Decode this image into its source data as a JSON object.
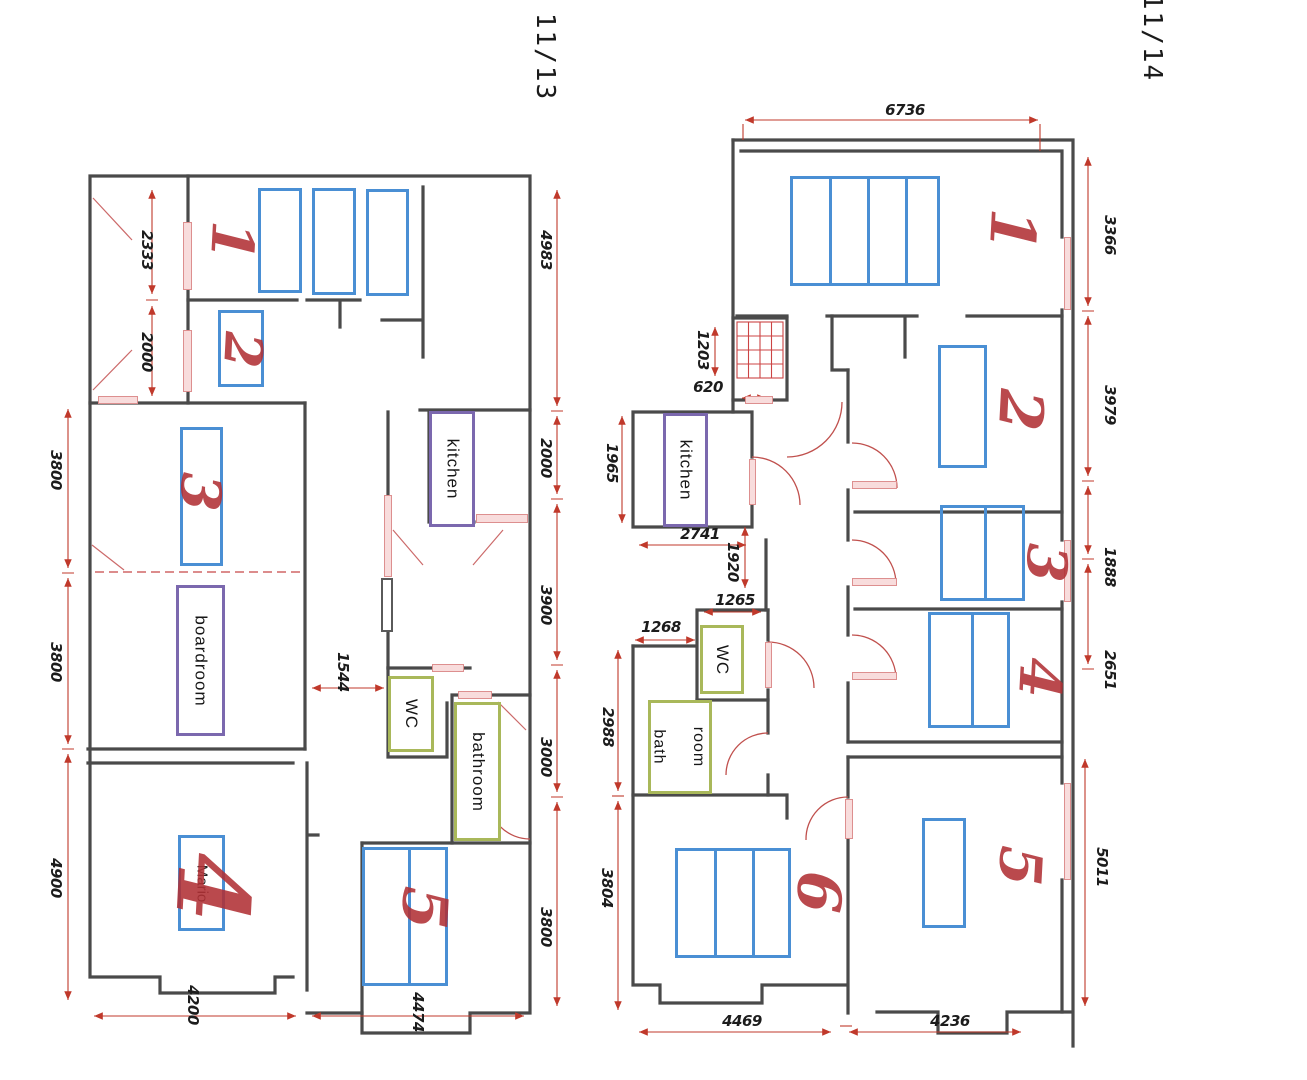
{
  "sheet": {
    "kind": "scanned architectural floor plans, two pages side by side"
  },
  "page_left": {
    "page_number": "11/13",
    "rooms": {
      "kitchen": "kitchen",
      "boardroom": "boardroom",
      "wc": "WC",
      "bathroom": "bathroom",
      "room4_name": "Mario"
    },
    "room_numbers": {
      "r1": "1",
      "r2": "2",
      "r3": "3",
      "r4": "4",
      "r5": "5"
    },
    "dimensions": {
      "left_a": "2333",
      "left_b": "2000",
      "left_c": "3800",
      "left_d": "3800",
      "left_e": "4900",
      "right_a": "4983",
      "right_b": "2000",
      "right_c": "3900",
      "right_d": "3000",
      "right_e": "3800",
      "corridor": "1544",
      "bottom_a": "4200",
      "bottom_b": "4474"
    }
  },
  "page_right": {
    "page_number": "11/14",
    "rooms": {
      "kitchen": "kitchen",
      "wc": "WC",
      "bath_line1": "bath",
      "bath_line2": "room"
    },
    "room_numbers": {
      "r1": "1",
      "r2": "2",
      "r3": "3",
      "r4": "4",
      "r5": "5",
      "r6": "6"
    },
    "dimensions": {
      "top": "6736",
      "right_a": "3366",
      "right_b": "3979",
      "right_c": "1888",
      "right_d": "2651",
      "right_e": "5011",
      "left_a": "1965",
      "left_b": "2988",
      "left_c": "3804",
      "stair": "1203",
      "entry": "620",
      "kitchen_w": "2741",
      "hall": "1920",
      "wc_w": "1265",
      "bath_w": "1268",
      "bottom_a": "4469",
      "bottom_b": "4236"
    }
  },
  "colors": {
    "wall": "#4a4a4a",
    "furniture_blue": "#4a8fd4",
    "label_purple": "#7b68ae",
    "label_green": "#a9b85a",
    "dimension_red": "#c0392b",
    "handwriting_red": "#b03034",
    "window_pink": "#f8dcdc"
  }
}
